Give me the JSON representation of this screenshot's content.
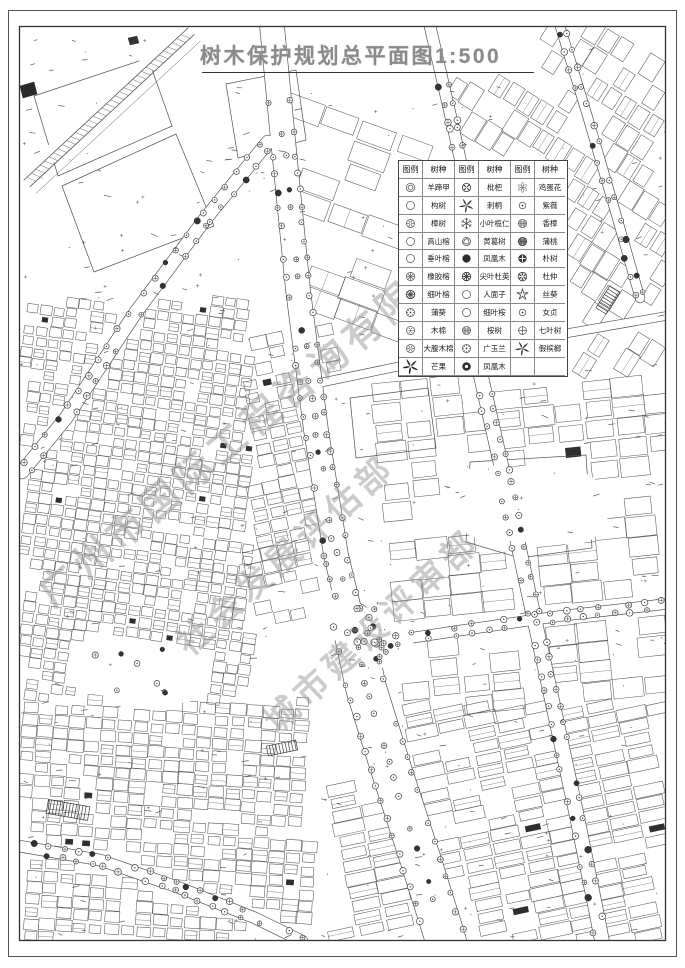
{
  "page": {
    "title": "树木保护规划总平面图1:500"
  },
  "watermarks": [
    "广州市国际工程咨询有限公司",
    "社会发展评估部",
    "城市建设评审部"
  ],
  "legend": {
    "header": {
      "symbol_label": "图例",
      "species_label": "树种"
    },
    "rows": [
      [
        {
          "icon": "double-circle",
          "name": "羊蹄甲"
        },
        {
          "icon": "swirl-dark",
          "name": "枇杷"
        },
        {
          "icon": "flower",
          "name": "鸡蛋花"
        }
      ],
      [
        {
          "icon": "circle",
          "name": "构树"
        },
        {
          "icon": "pinwheel",
          "name": "刺桐"
        },
        {
          "icon": "circle-dot",
          "name": "紫薇"
        }
      ],
      [
        {
          "icon": "circle-star",
          "name": "樟树"
        },
        {
          "icon": "snowflake",
          "name": "小叶榄仁"
        },
        {
          "icon": "circle-mesh",
          "name": "香樟"
        }
      ],
      [
        {
          "icon": "circle",
          "name": "高山榕"
        },
        {
          "icon": "circle-swirl",
          "name": "黄葛树"
        },
        {
          "icon": "circle-mesh-dark",
          "name": "蒲桃"
        }
      ],
      [
        {
          "icon": "circle",
          "name": "垂叶榕"
        },
        {
          "icon": "circle-fill",
          "name": "凤凰木"
        },
        {
          "icon": "circle-cross-dark",
          "name": "朴树"
        }
      ],
      [
        {
          "icon": "circle-spokes",
          "name": "橡胶榕"
        },
        {
          "icon": "circle-star-dark",
          "name": "尖叶杜英"
        },
        {
          "icon": "circle-petals-dark",
          "name": "杜仲"
        }
      ],
      [
        {
          "icon": "circle-spokes-dense",
          "name": "细叶榕"
        },
        {
          "icon": "circle",
          "name": "人面子"
        },
        {
          "icon": "star",
          "name": "丝葵"
        }
      ],
      [
        {
          "icon": "circle-clock",
          "name": "蒲葵"
        },
        {
          "icon": "circle",
          "name": "细叶桉"
        },
        {
          "icon": "circle-dot",
          "name": "女贞"
        }
      ],
      [
        {
          "icon": "circle-dot-ring",
          "name": "木棉"
        },
        {
          "icon": "circle-mesh",
          "name": "桉树"
        },
        {
          "icon": "circle-cross",
          "name": "七叶树"
        }
      ],
      [
        {
          "icon": "circle-star",
          "name": "大腹木棉"
        },
        {
          "icon": "circle-clock",
          "name": "广玉兰"
        },
        {
          "icon": "pinwheel",
          "name": "假槟榔"
        }
      ],
      [
        {
          "icon": "pinwheel-dark",
          "name": "芒果"
        },
        {
          "icon": "circle-fill-ring",
          "name": "凤凰木"
        },
        {
          "icon": "",
          "name": ""
        }
      ]
    ]
  }
}
